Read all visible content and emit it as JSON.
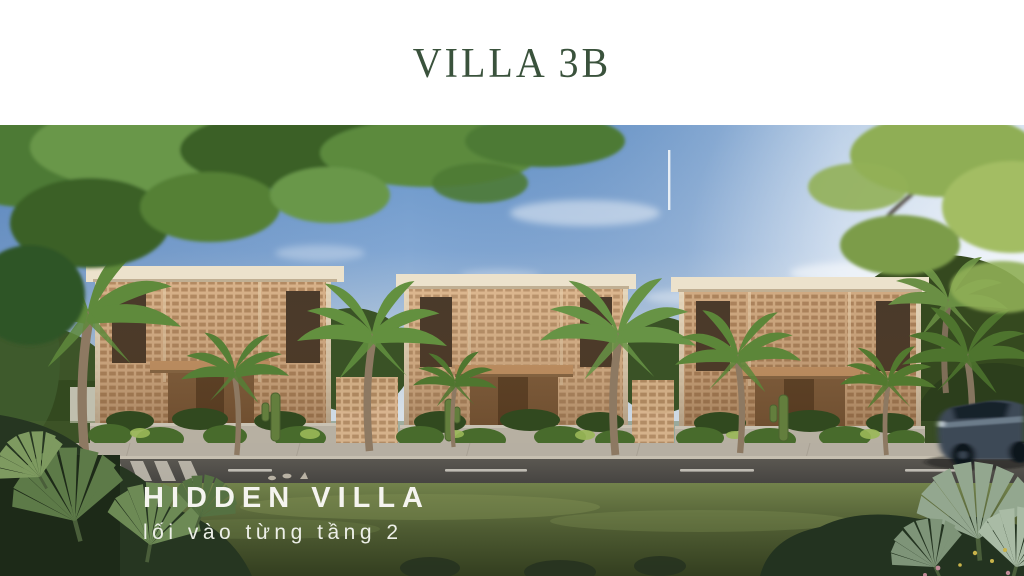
{
  "header": {
    "title": "VILLA 3B",
    "title_color": "#3a523c",
    "background": "#ffffff"
  },
  "hero_overlay": {
    "title": "HIDDEN VILLA",
    "subtitle": "lối vào từng tầng 2",
    "text_color": "#f2f1ec"
  },
  "scene": {
    "description": "Daylight architectural rendering of three cubic villas with tan latticed brick facades, cream roof bands, wood entries, hedge planters, palm trees, a street with crosswalk and lane dashes, grass verge with tropical plants, and a dark car passing at right",
    "colors": {
      "sky_top": "#6593c8",
      "sky_horizon": "#d8e1e8",
      "facade": "#d8b28a",
      "facade_grid": "#aa8058",
      "roof_band": "#ece2cc",
      "entry_wood": "#c9996a",
      "sidewalk": "#b2ab9d",
      "road": "#4c4a46",
      "lane_marking": "#d2cfc6",
      "grass": "#5f6f40",
      "foliage_dark": "#263621",
      "palm_green": "#5f8a3c",
      "car_body": "#3c4856"
    },
    "elements": [
      "sky",
      "sun-glare",
      "clouds",
      "flagpole",
      "overhanging-branches",
      "villa-left",
      "villa-center",
      "villa-right",
      "palm-trees",
      "cacti",
      "hedge-planters",
      "sidewalk",
      "crosswalk",
      "road",
      "lane-markings",
      "birds",
      "grass-verge",
      "foreground-plants",
      "car"
    ]
  }
}
